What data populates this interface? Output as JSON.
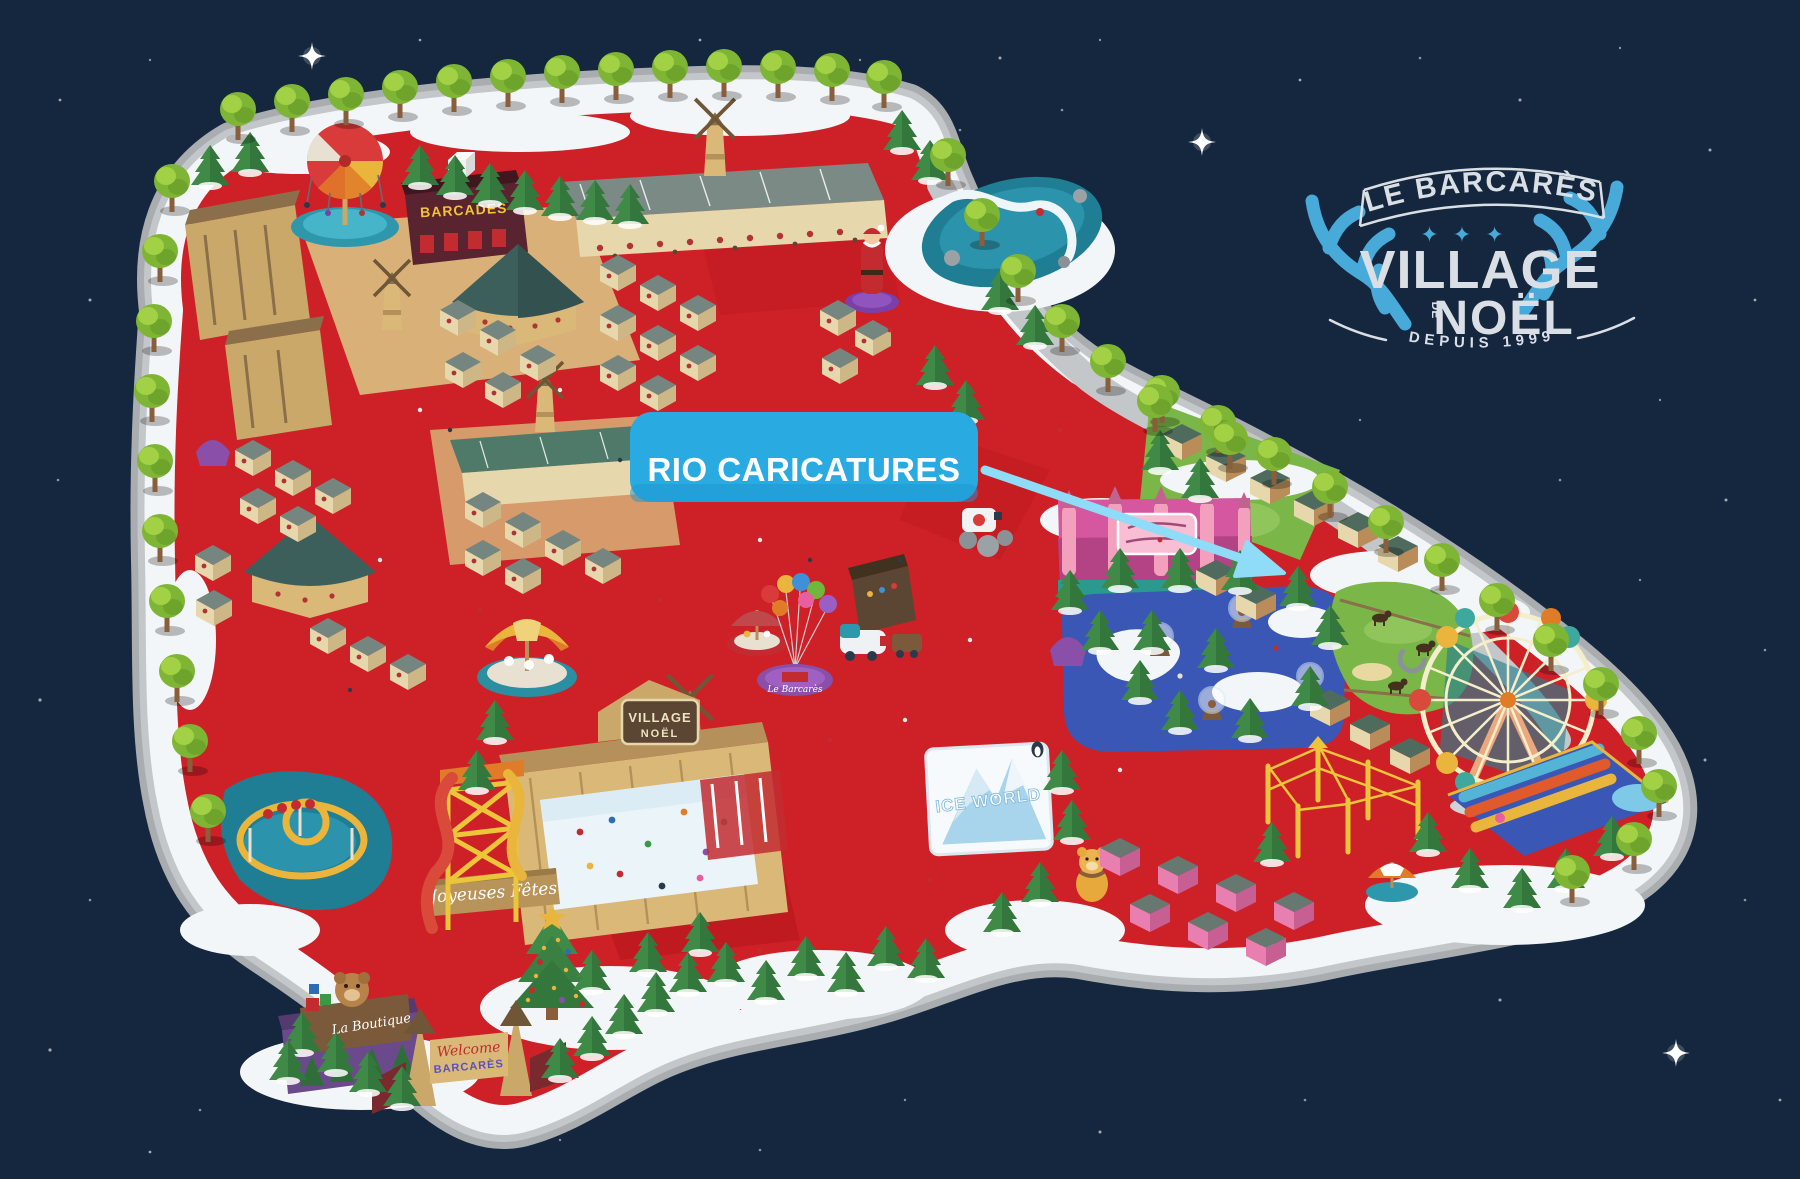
{
  "scene": {
    "sky_color": "#15273f",
    "ground_color": "#ce2127",
    "path_color": "#bcbfc1",
    "snow_color": "#f3f6f8",
    "pond_color": "#1f7d94",
    "river_color": "#3a57b5"
  },
  "logo": {
    "town": "LE BARCARÈS",
    "stars": "✦ ✦ ✦",
    "title": "VILLAGE",
    "of": "DE",
    "title2": "NOËL",
    "since": "DEPUIS 1999",
    "text_color": "#d9dfe5",
    "antler_color": "#47aad9"
  },
  "callout": {
    "label": "RIO CARICATURES",
    "background": "#29abe2",
    "arrow_color": "#8edcf8",
    "text_color": "#ffffff"
  },
  "park_signs": {
    "barcades": "BARCADES",
    "rink_title": "VILLAGE",
    "rink_title2": "NOËL",
    "banner": "Joyeuses Fêtes",
    "ice_world": "ICE WORLD",
    "boutique": "La Boutique",
    "balloon_stand": "Le Barcarès",
    "gate_welcome": "Welcome",
    "gate_name": "BARCARÈS"
  }
}
